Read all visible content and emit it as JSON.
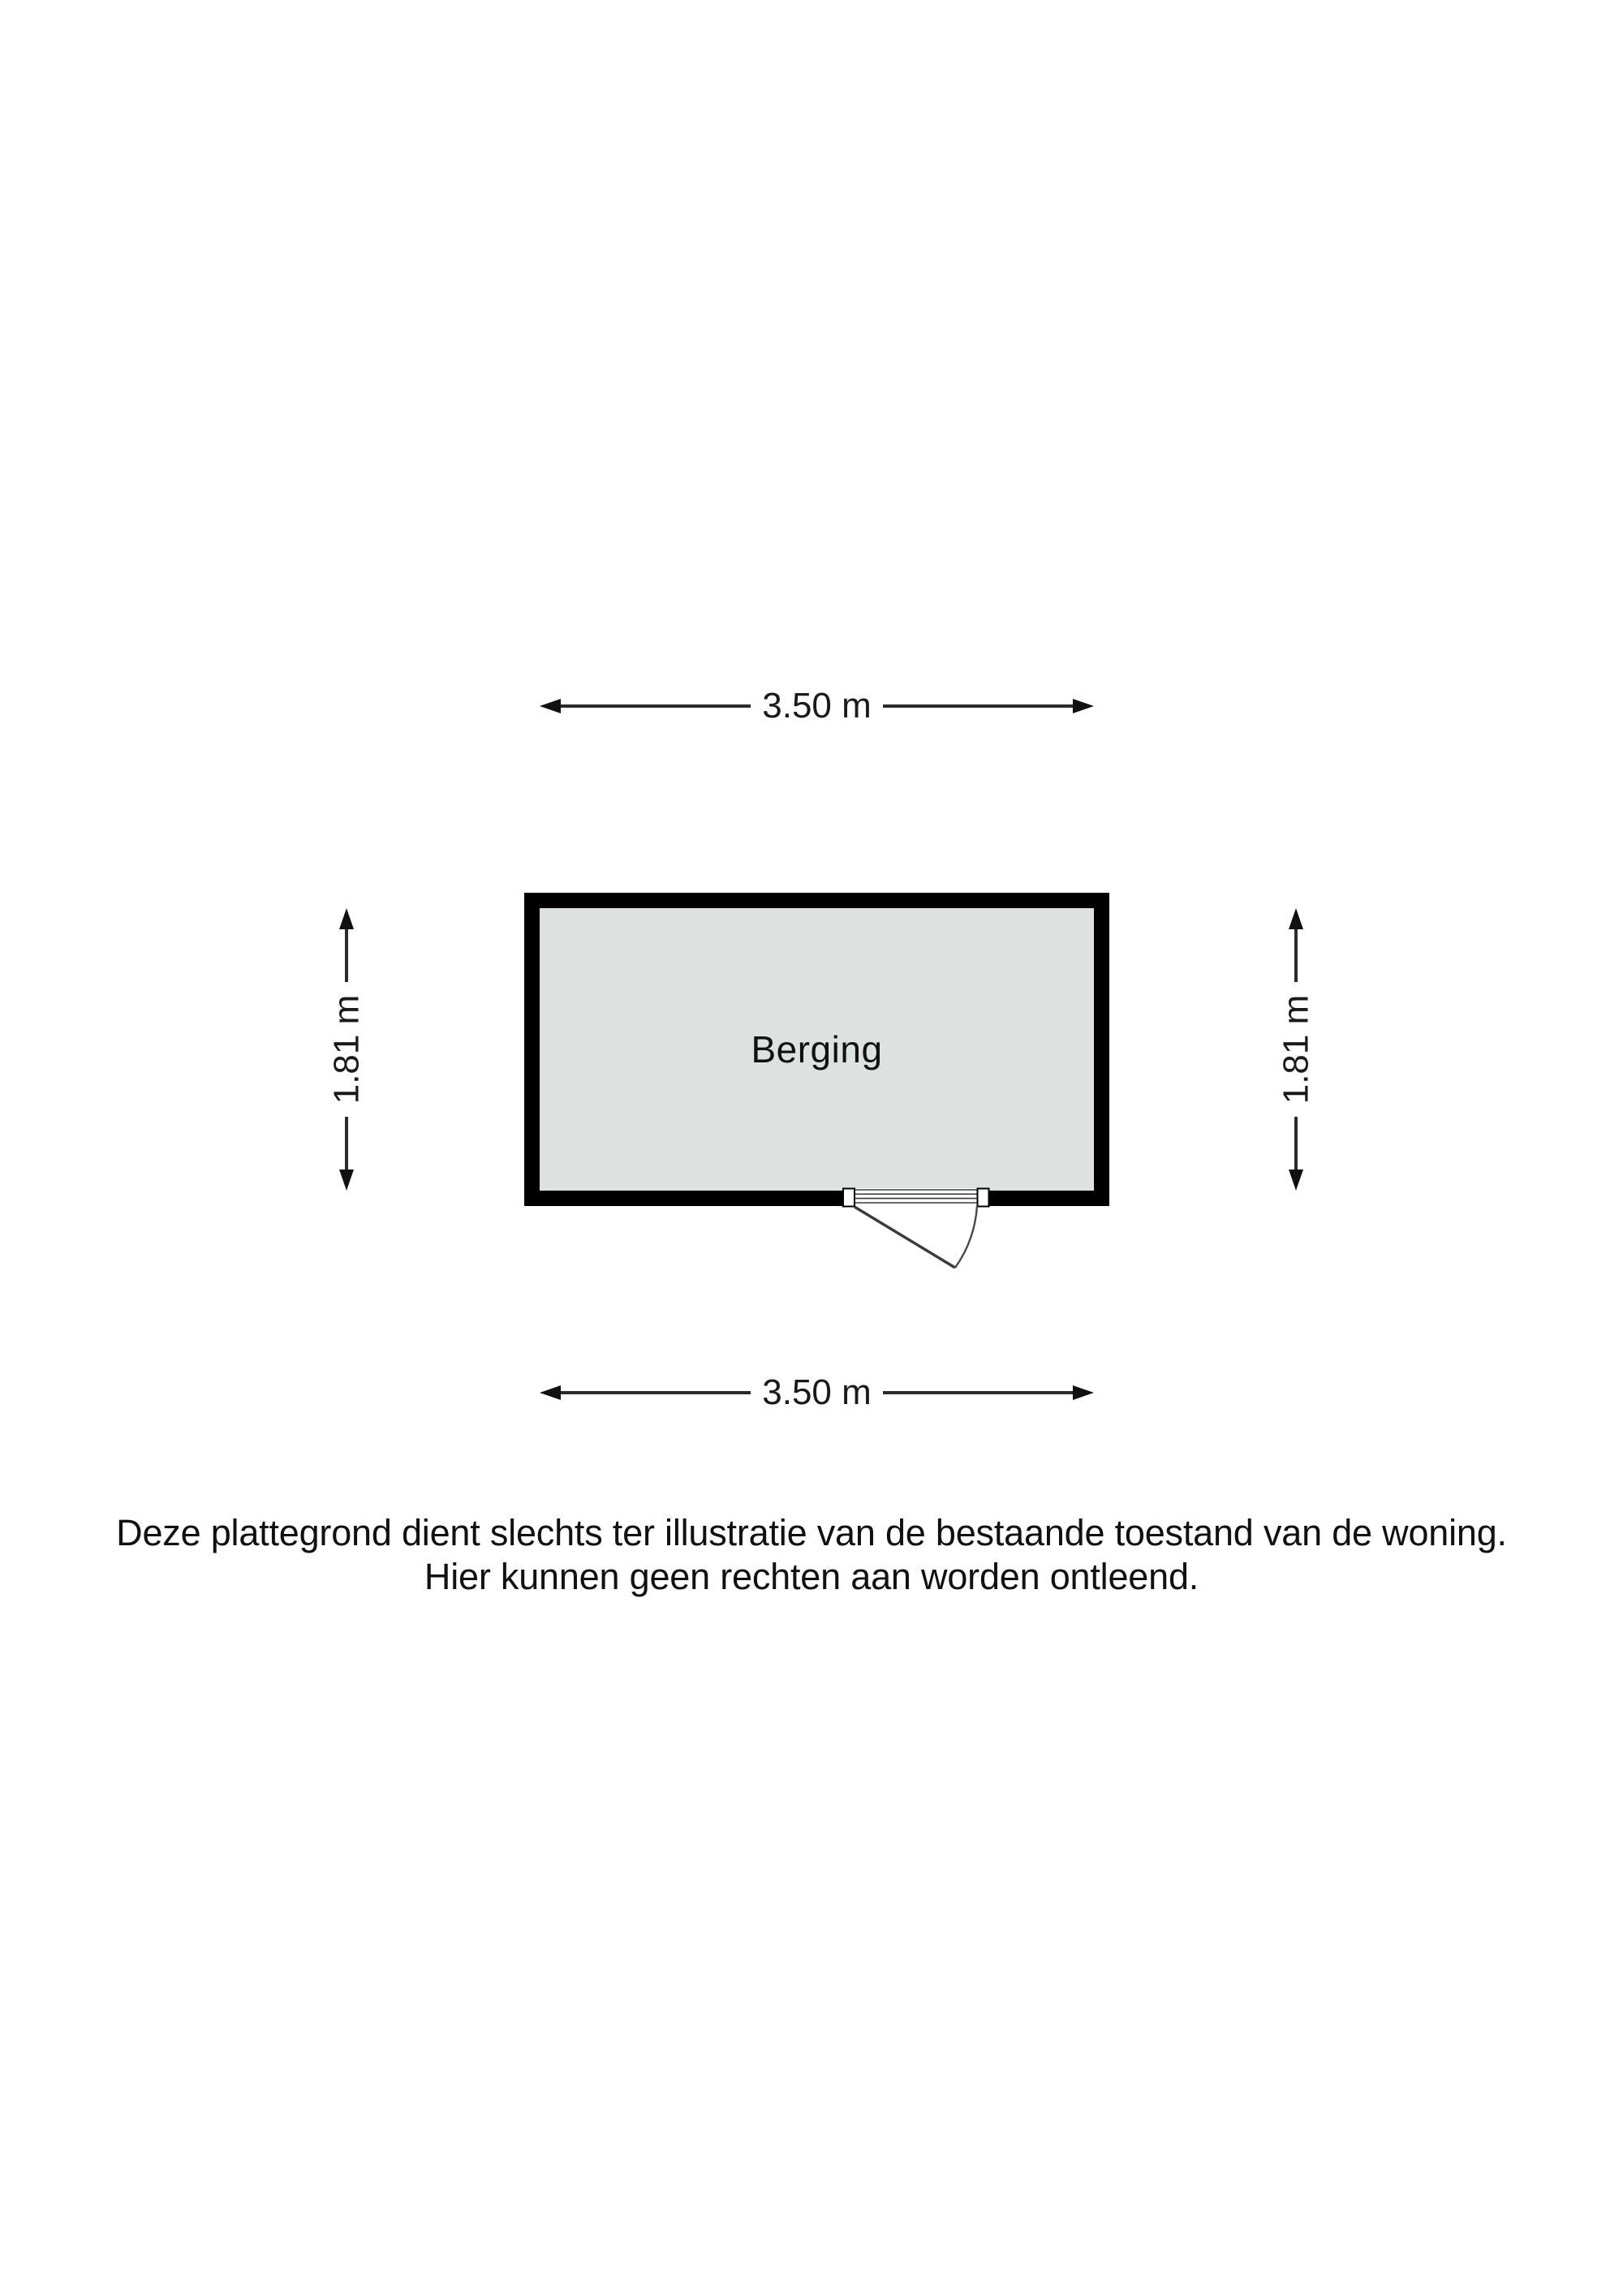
{
  "floorplan": {
    "room": {
      "label": "Berging"
    },
    "dimensions": {
      "top": "3.50 m",
      "bottom": "3.50 m",
      "left": "1.81 m",
      "right": "1.81 m"
    },
    "door": {
      "type": "single-swing",
      "wall": "bottom"
    },
    "disclaimer": {
      "line1": "Deze plattegrond dient slechts ter illustratie van de bestaande toestand van de woning.",
      "line2": "Hier kunnen geen rechten aan worden ontleend."
    },
    "colors": {
      "wall": "#000000",
      "floor_fill": "#dde1e0",
      "dimension_line": "#2b2b2b",
      "text": "#1a1a1a",
      "background": "#ffffff"
    },
    "icons": {
      "arrow-left-icon": "css-triangle-left",
      "arrow-right-icon": "css-triangle-right",
      "arrow-up-icon": "css-triangle-up",
      "arrow-down-icon": "css-triangle-down"
    }
  }
}
